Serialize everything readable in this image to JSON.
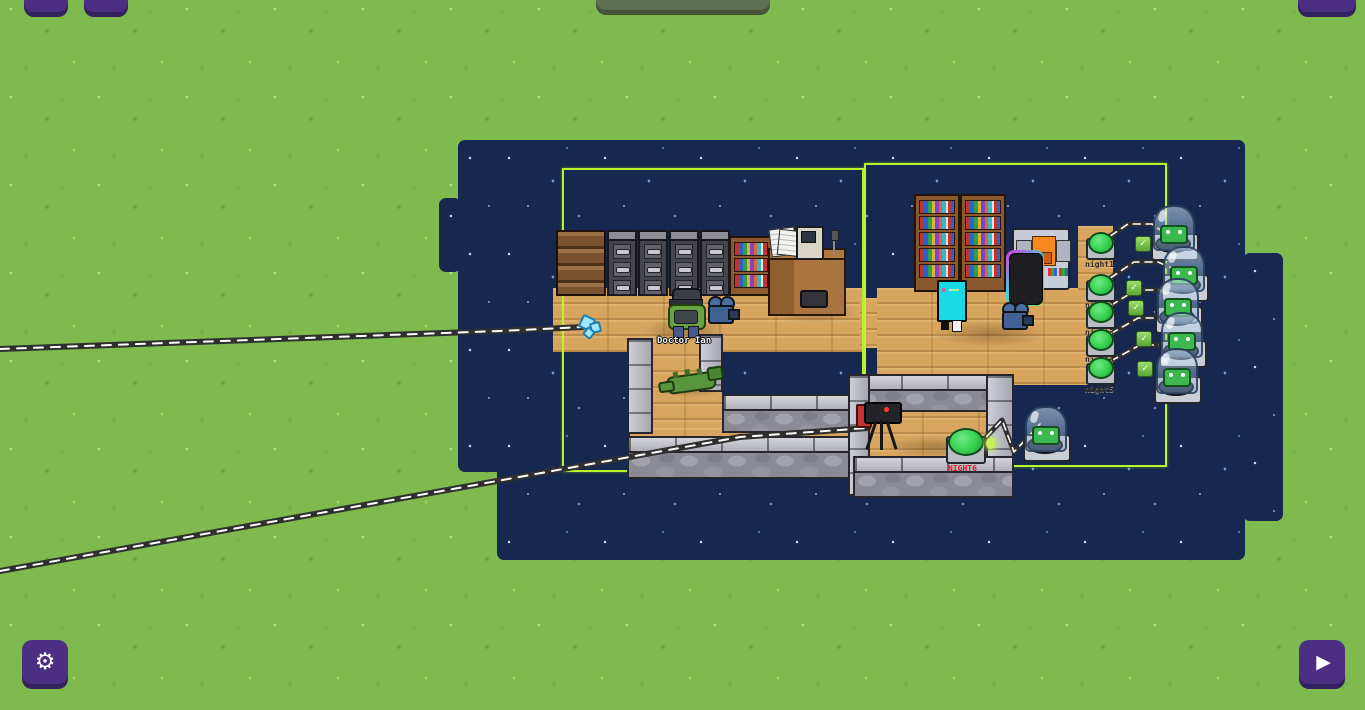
{
  "hud": {
    "settings_glyph": "⚙",
    "play_glyph": "▶"
  },
  "scene": {
    "character": {
      "name": "Doctor Ian"
    },
    "wall_switches": [
      {
        "label": "night1"
      },
      {
        "label": "night2"
      },
      {
        "label": "night3"
      },
      {
        "label": "night4"
      },
      {
        "label": "night5"
      }
    ],
    "floor_switch": {
      "label": "NIGHT6"
    },
    "pods": [
      {
        "alien": true
      },
      {
        "alien": true
      },
      {
        "alien": true
      },
      {
        "alien": true
      },
      {
        "alien": true
      },
      {
        "alien": true
      }
    ],
    "checkmark_glyph": "✓"
  },
  "colors": {
    "grass": "#7eba4e",
    "night_sky": "#16284f",
    "zone_outline": "#b7f62a",
    "hud_button_purple": "#4c2f82",
    "hud_button_olive": "#5d6f50",
    "wood_floor": "#d7a55e",
    "stone_wall": "#8a8b95",
    "wire": "#2f2f2f",
    "switch_green": "#35d04e",
    "night6_label_red": "#e01818"
  }
}
